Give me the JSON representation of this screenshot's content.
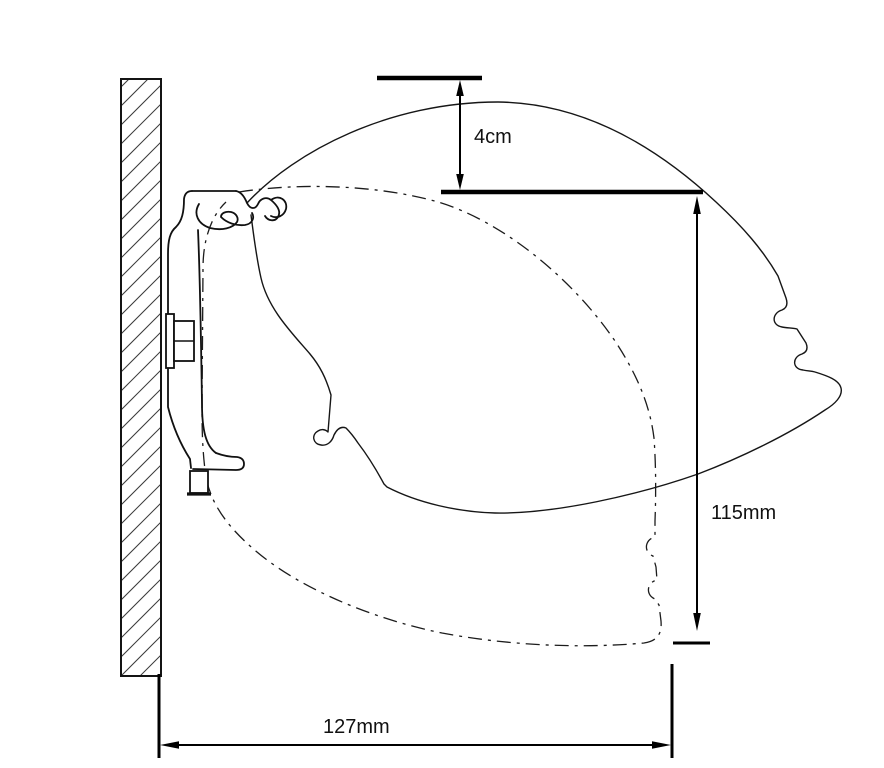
{
  "colors": {
    "background": "#ffffff",
    "line": "#000000",
    "text": "#111111"
  },
  "dimensions": {
    "top_offset": {
      "label": "4cm",
      "orientation": "vertical"
    },
    "height": {
      "label": "115mm",
      "orientation": "vertical"
    },
    "depth": {
      "label": "127mm",
      "orientation": "horizontal"
    }
  },
  "elements": {
    "wall": "wall-cross-section",
    "bracket": "mounting-bracket-profile",
    "cassette_raised": "cassette-outline-raised-solid",
    "cassette_lowered": "cassette-outline-lowered-dash-dot"
  }
}
